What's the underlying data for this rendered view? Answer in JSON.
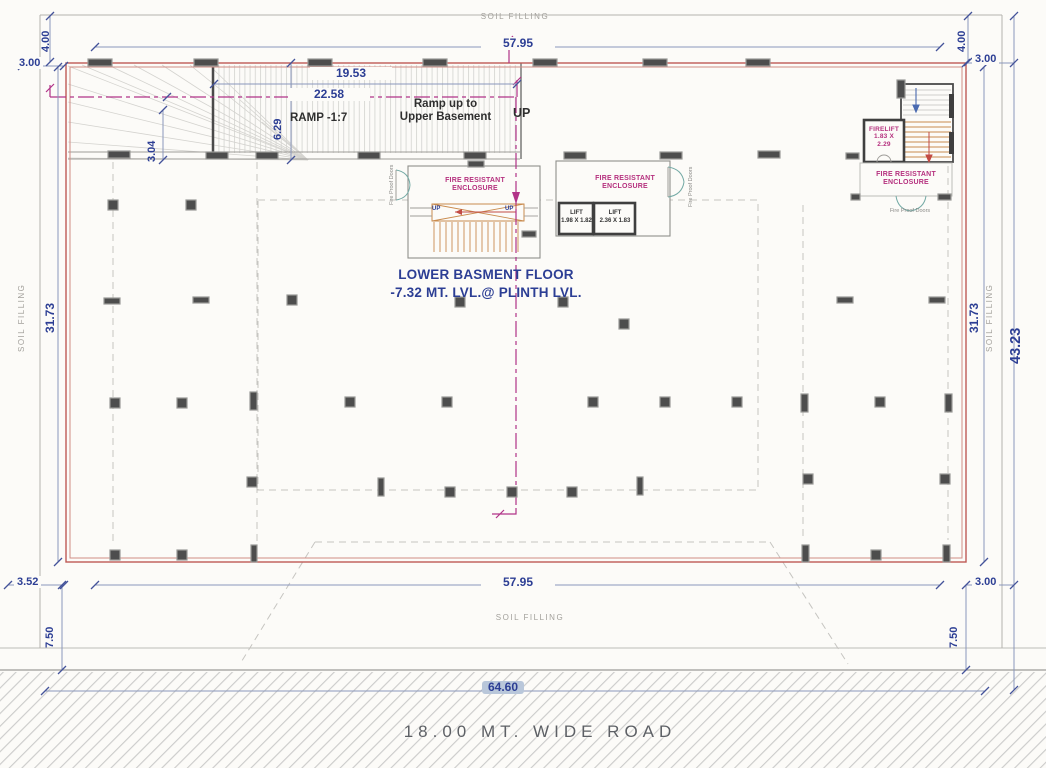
{
  "drawing": {
    "floor_title_line1": "LOWER BASMENT FLOOR",
    "floor_title_line2": "-7.32 MT. LVL.@ PLINTH LVL.",
    "road_label": "18.00 MT. WIDE ROAD",
    "ramp": {
      "slope_label": "RAMP -1:7",
      "note_line1": "Ramp up to",
      "note_line2": "Upper Basement",
      "up_label": "UP"
    },
    "stair_core": {
      "fire_line1": "FIRE RESISTANT",
      "fire_line2": "ENCLOSURE",
      "up_left": "UP",
      "up_right": "UP",
      "door_label": "Fire Proof Doors"
    },
    "lift_core": {
      "fire_line1": "FIRE RESISTANT",
      "fire_line2": "ENCLOSURE",
      "lift1_name": "LIFT",
      "lift1_size": "1.98 X 1.82",
      "lift2_name": "LIFT",
      "lift2_size": "2.36 X 1.83",
      "door_label": "Fire Proof Doors"
    },
    "right_core": {
      "firelift_line1": "FIRELIFT",
      "firelift_line2": "1.83 X",
      "firelift_line3": "2.29",
      "fire_line1": "FIRE RESISTANT",
      "fire_line2": "ENCLOSURE",
      "door_label": "Fire Proof Doors"
    },
    "soil_filling": {
      "top": "SOIL FILLING",
      "bottom": "SOIL FILLING",
      "left": "SOIL FILLING",
      "right": "SOIL FILLING"
    },
    "dimensions": {
      "top_width": "57.95",
      "bottom_width": "57.95",
      "overall_width": "64.60",
      "overall_depth": "43.23",
      "left_depth": "31.73",
      "right_depth": "31.73",
      "ramp_len_upper": "19.53",
      "ramp_len_center": "22.58",
      "ramp_width": "6.29",
      "ramp_side": "3.04",
      "top_left_offset": "3.00",
      "top_right_offset": "3.00",
      "bottom_left_offset": "3.52",
      "bottom_right_offset": "3.00",
      "soil_top_left": "4.00",
      "soil_top_right": "4.00",
      "soil_bottom_left": "7.50",
      "soil_bottom_right": "7.50"
    },
    "colors": {
      "wall_red": "#bf5a55",
      "centerline_magenta": "#b13388",
      "dimension_blue": "#2c3e94",
      "fire_text_magenta": "#b5307e",
      "stair_orange": "#c98b4e",
      "door_teal": "#74aaa5",
      "column_gray": "#4d4d4d"
    }
  }
}
